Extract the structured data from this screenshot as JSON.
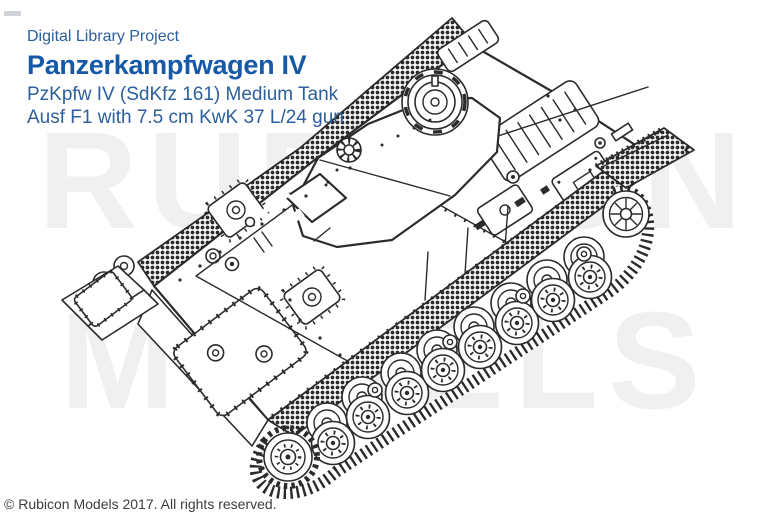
{
  "header": {
    "eyebrow": "Digital Library Project",
    "title": "Panzerkampfwagen IV",
    "subtitle_line1": "PzKpfw IV (SdKfz 161) Medium Tank",
    "subtitle_line2": "Ausf F1 with 7.5 cm KwK 37 L/24 gun"
  },
  "watermark": {
    "line1": "RUBICON",
    "line2": "MODELS"
  },
  "illustration": {
    "alt": "Black-and-white technical line illustration of a Panzerkampfwagen IV Ausf F1 medium tank seen from the upper front-left: short 7.5 cm KwK 37 L/24 gun, turret with commander's cupola, eight overlapping road wheels, drive sprocket, idler wheel, and dotted anti-slip fenders"
  },
  "footer": {
    "copyright": "© Rubicon Models 2017. All rights reserved."
  },
  "colors": {
    "title_blue": "#1659a7",
    "body_blue": "#2c5f9c",
    "watermark_gray": "#f0f0f0",
    "line_dark": "#2b2b2b",
    "footer_gray": "#3d3d3d",
    "background": "#ffffff"
  }
}
